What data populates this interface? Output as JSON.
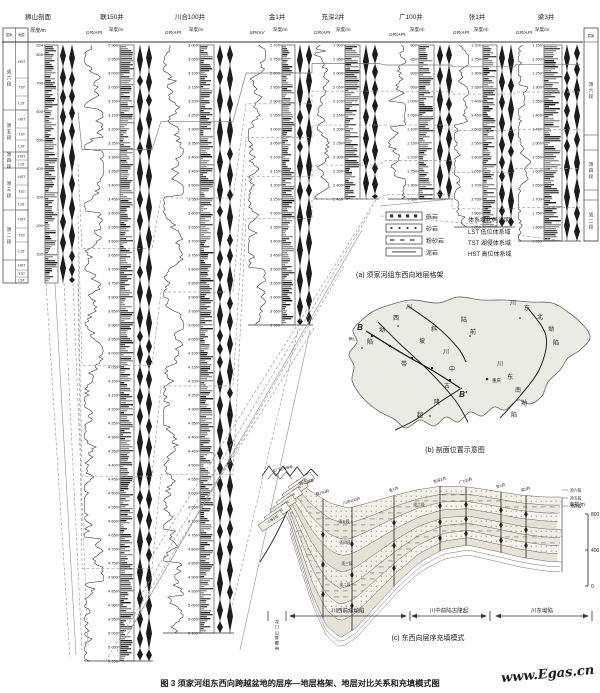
{
  "figure": {
    "caption": "图 3  须家河组东西向跨越盆地的层序—地层格架、地层对比关系和充填模式图",
    "watermark": "www.Egas.cn"
  },
  "section": {
    "title": "狮山剖面",
    "thickness_label": "厚度/m",
    "header": "层序地层",
    "total_thickness": 834,
    "ticks": [
      834,
      800,
      700,
      600,
      500,
      400,
      300,
      200,
      100
    ],
    "members": [
      "须六段",
      "须五段",
      "须四段",
      "须三段",
      "须二段"
    ],
    "tracts": [
      "HST",
      "TST",
      "LST"
    ]
  },
  "wells": [
    {
      "name": "联150井",
      "curve_label": "GR/API",
      "depth_label": "深度/m",
      "top_depth": 2900,
      "bottom_depth": 5100,
      "tick_step": 50
    },
    {
      "name": "川合100井",
      "curve_label": "GR/API",
      "depth_label": "深度/m",
      "top_depth": 3000,
      "bottom_depth": 5100,
      "tick_step": 50
    },
    {
      "name": "金1井",
      "curve_label": "SP/mV",
      "depth_label": "深度/m",
      "top_depth": 2700,
      "bottom_depth": 3700,
      "tick_step": 50
    },
    {
      "name": "充深2井",
      "curve_label": "GR/API",
      "depth_label": "深度/m",
      "top_depth": 1900,
      "bottom_depth": 2450,
      "tick_step": 50
    },
    {
      "name": "广100井",
      "curve_label": "GR/API",
      "depth_label": "深度/m",
      "top_depth": 800,
      "bottom_depth": 1350,
      "tick_step": 50
    },
    {
      "name": "张1井",
      "curve_label": "GR/API",
      "depth_label": "深度/m",
      "top_depth": 1200,
      "bottom_depth": 1850,
      "tick_step": 50
    },
    {
      "name": "梁3井",
      "curve_label": "GR/API",
      "depth_label": "深度/m",
      "top_depth": 1150,
      "bottom_depth": 1850,
      "tick_step": 50
    }
  ],
  "liang3_members": [
    "须六段",
    "须四段",
    "须二段"
  ],
  "liang3_col_header": "层序",
  "legend": {
    "items": [
      "砾岩",
      "砂岩",
      "粉砂岩",
      "泥岩"
    ],
    "tracts_title": "体系域代码说明：",
    "tracts": [
      "LST 低位体系域",
      "TST 湖侵体系域",
      "HST 高位体系域"
    ]
  },
  "captions": {
    "a": "(a) 须家河组东西向地层格架",
    "b": "(b) 剖面位置示意图",
    "c": "(c) 东西向层序充填模式"
  },
  "map": {
    "b_start": "B",
    "b_end": "B′",
    "city": "重庆",
    "labels": [
      {
        "t": "川",
        "x": 409,
        "y": 309
      },
      {
        "t": "西",
        "x": 396,
        "y": 320
      },
      {
        "t": "坳",
        "x": 382,
        "y": 332
      },
      {
        "t": "陷",
        "x": 370,
        "y": 344
      },
      {
        "t": "斜",
        "x": 434,
        "y": 331
      },
      {
        "t": "坡",
        "x": 422,
        "y": 343
      },
      {
        "t": "带",
        "x": 404,
        "y": 366
      },
      {
        "t": "前",
        "x": 473,
        "y": 334
      },
      {
        "t": "陆",
        "x": 464,
        "y": 322
      },
      {
        "t": "川",
        "x": 446,
        "y": 354
      },
      {
        "t": "中",
        "x": 452,
        "y": 371
      },
      {
        "t": "古",
        "x": 447,
        "y": 388
      },
      {
        "t": "隆",
        "x": 437,
        "y": 404
      },
      {
        "t": "起",
        "x": 420,
        "y": 417
      },
      {
        "t": "川",
        "x": 513,
        "y": 305
      },
      {
        "t": "东",
        "x": 527,
        "y": 310
      },
      {
        "t": "北",
        "x": 540,
        "y": 319
      },
      {
        "t": "坳",
        "x": 551,
        "y": 331
      },
      {
        "t": "陷",
        "x": 556,
        "y": 345
      },
      {
        "t": "川",
        "x": 500,
        "y": 366
      },
      {
        "t": "东",
        "x": 510,
        "y": 379
      },
      {
        "t": "南",
        "x": 518,
        "y": 392
      },
      {
        "t": "坳",
        "x": 524,
        "y": 405
      },
      {
        "t": "陷",
        "x": 514,
        "y": 417
      },
      {
        "t": "狮山",
        "x": 352,
        "y": 340,
        "s": 3.5
      }
    ]
  },
  "model": {
    "wells": [
      "狮山剖面",
      "联150井",
      "川合100井",
      "金1井",
      "充深2井",
      "广100井",
      "张1井",
      "梁3井"
    ],
    "west_stack": [
      "遂宁组",
      "须五段",
      "须四段",
      "须三段",
      "须二段",
      "小塘子组"
    ],
    "member_labels": [
      "须六段",
      "须五段",
      "须四段",
      "须三段",
      "须二段"
    ],
    "right_labels": [
      "须六段",
      "须五段",
      "须四段"
    ],
    "thrust_top": "龙门山冲断带",
    "thrust_side": "龙门山推覆带",
    "zones": [
      "川西前缘坳陷",
      "川中前陆古隆起",
      "川东坳陷"
    ],
    "elev": {
      "label": "海拔/m",
      "ticks": [
        "800",
        "400",
        "0"
      ]
    }
  }
}
